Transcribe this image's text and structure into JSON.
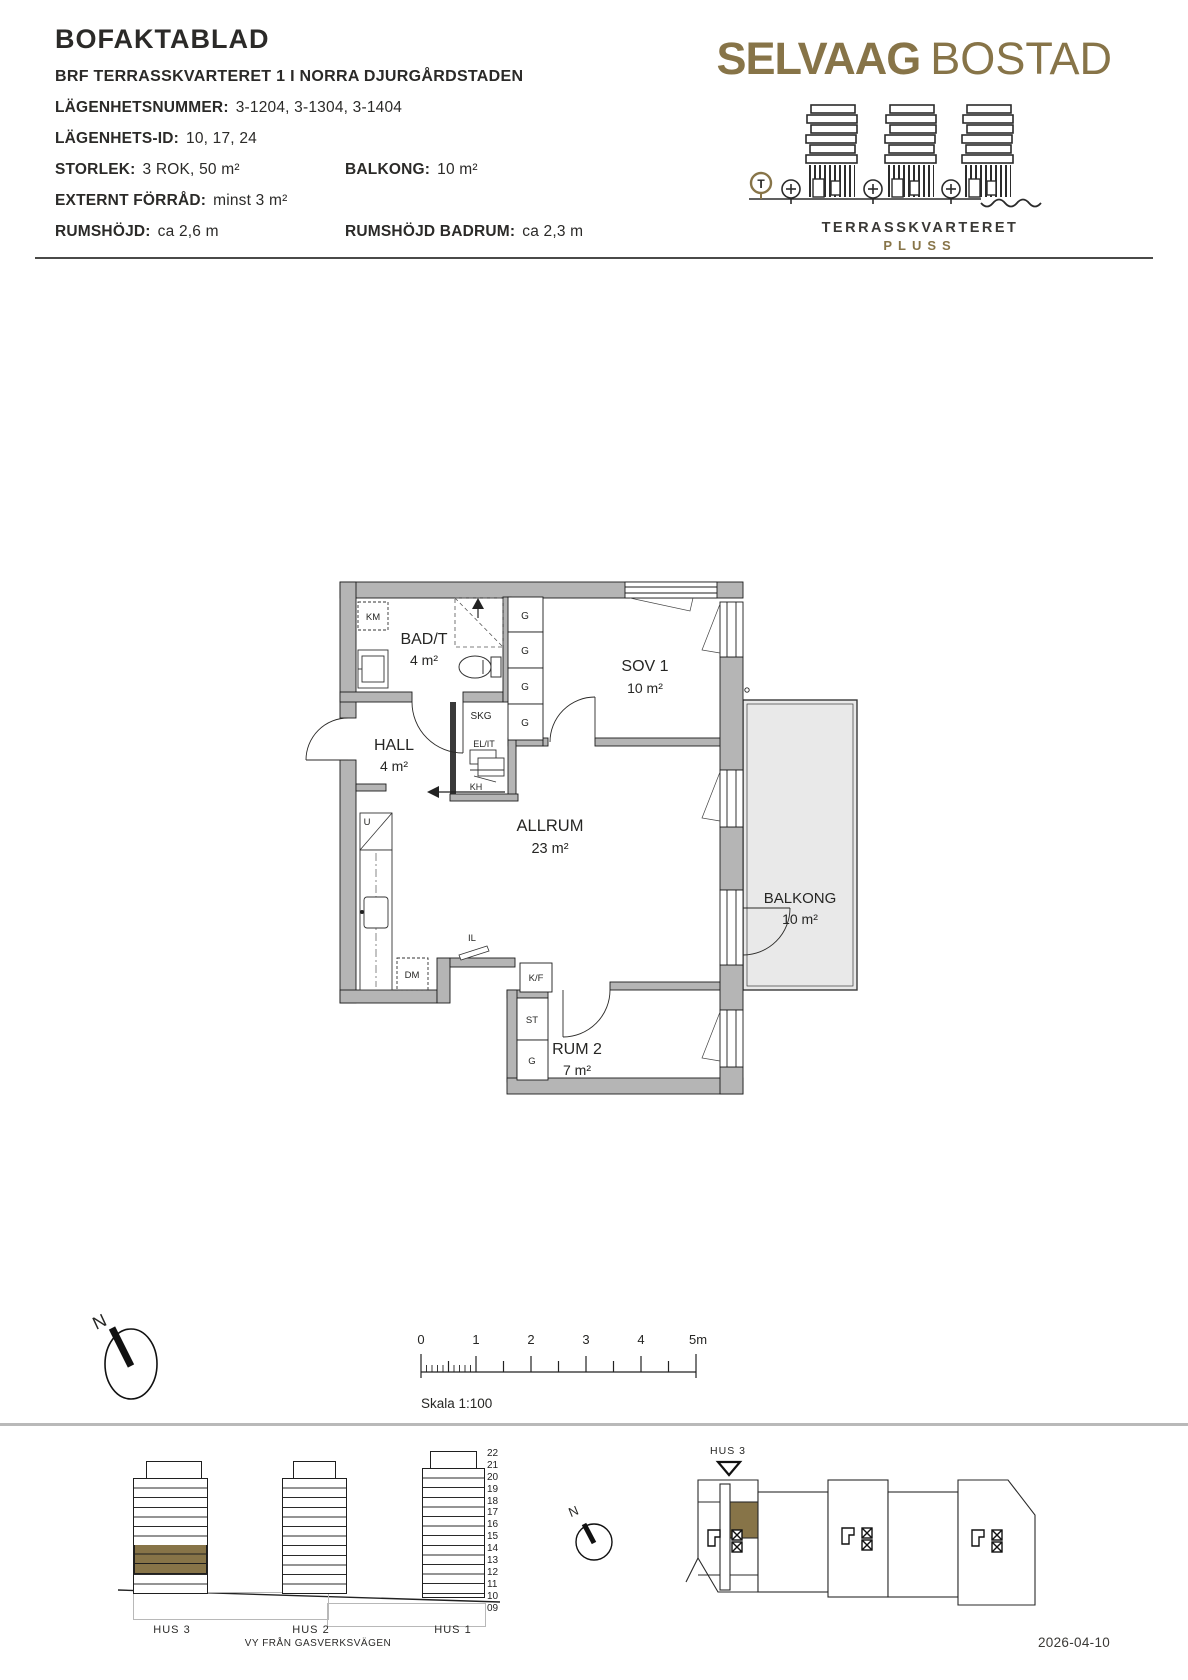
{
  "header": {
    "title": "BOFAKTABLAD",
    "project_line": "BRF TERRASSKVARTERET 1 I NORRA DJURGÅRDSTADEN",
    "fields": {
      "lgh_nr_label": "LÄGENHETSNUMMER:",
      "lgh_nr_value": "3-1204, 3-1304, 3-1404",
      "lgh_id_label": "LÄGENHETS-ID:",
      "lgh_id_value": "10, 17, 24",
      "storlek_label": "STORLEK:",
      "storlek_value": "3 ROK, 50 m²",
      "balkong_label": "BALKONG:",
      "balkong_value": "10 m²",
      "forrad_label": "EXTERNT FÖRRÅD:",
      "forrad_value": "minst 3 m²",
      "rumshojd_label": "RUMSHÖJD:",
      "rumshojd_value": "ca 2,6 m",
      "rumshojd_badrum_label": "RUMSHÖJD BADRUM:",
      "rumshojd_badrum_value": "ca 2,3 m"
    }
  },
  "logo": {
    "brand_primary": "SELVAAG",
    "brand_secondary": "BOSTAD",
    "project": "TERRASSKVARTERET",
    "suffix": "PLUSS",
    "tram_letter": "T"
  },
  "floorplan": {
    "rooms": {
      "bad": {
        "name": "BAD/T",
        "area": "4 m²"
      },
      "hall": {
        "name": "HALL",
        "area": "4 m²"
      },
      "sov1": {
        "name": "SOV 1",
        "area": "10 m²"
      },
      "allrum": {
        "name": "ALLRUM",
        "area": "23 m²"
      },
      "rum2": {
        "name": "RUM 2",
        "area": "7 m²"
      },
      "balkong": {
        "name": "BALKONG",
        "area": "10 m²"
      }
    },
    "fixtures": {
      "km": "KM",
      "g": "G",
      "skg": "SKG",
      "el_it": "EL/IT",
      "kh": "KH",
      "u": "U",
      "dm": "DM",
      "il": "IL",
      "kf": "K/F",
      "st": "ST"
    }
  },
  "compass": {
    "north": "N"
  },
  "scalebar": {
    "ticks": [
      "0",
      "1",
      "2",
      "3",
      "4",
      "5m"
    ],
    "caption": "Skala 1:100"
  },
  "elevation": {
    "floor_numbers": [
      "22",
      "21",
      "20",
      "19",
      "18",
      "17",
      "16",
      "15",
      "14",
      "13",
      "12",
      "11",
      "10",
      "09"
    ],
    "hus3": "HUS 3",
    "hus2": "HUS 2",
    "hus1": "HUS 1",
    "caption": "VY FRÅN GASVERKSVÄGEN"
  },
  "siteplan": {
    "hus3_label": "HUS 3"
  },
  "footer": {
    "date": "2026-04-10"
  },
  "colors": {
    "gold": "#877448",
    "wall_gray": "#b5b5b5",
    "balcony_fill": "#e9e9e9"
  }
}
